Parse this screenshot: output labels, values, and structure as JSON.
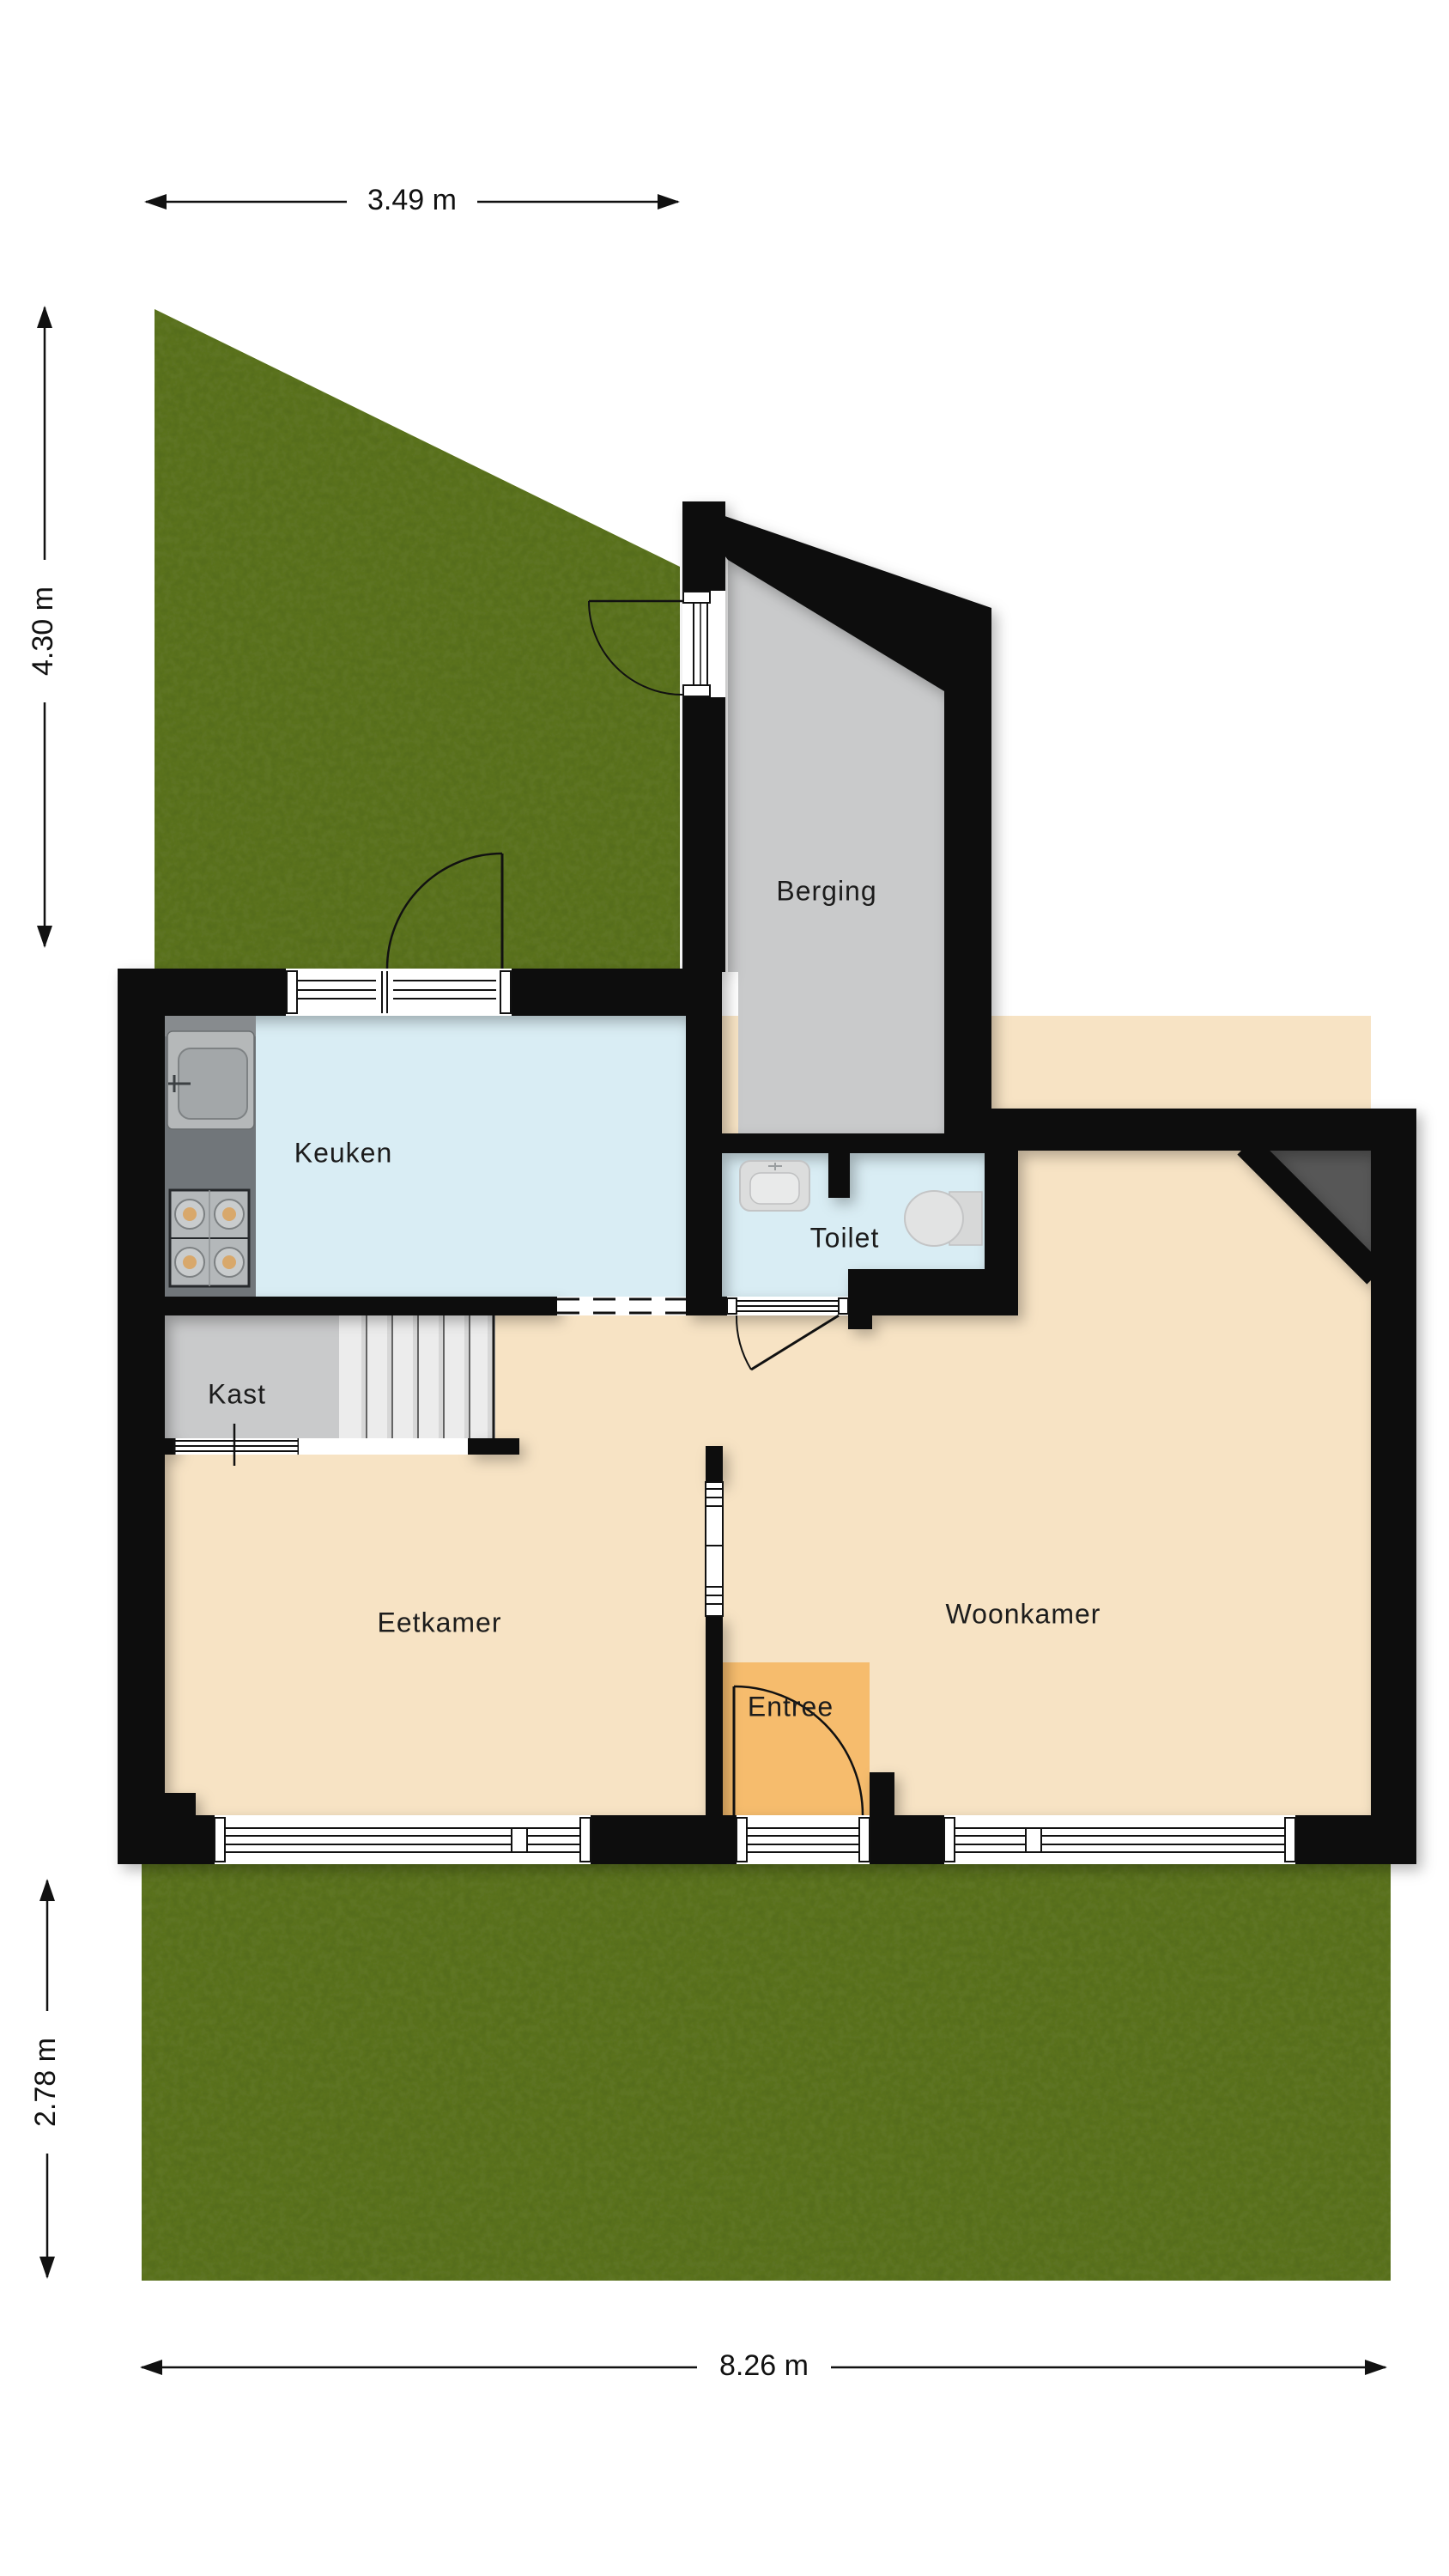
{
  "plan": {
    "type": "residential-floorplan-ground-floor",
    "units": "m"
  },
  "rooms": [
    {
      "id": "berging",
      "label": "Berging"
    },
    {
      "id": "keuken",
      "label": "Keuken"
    },
    {
      "id": "toilet",
      "label": "Toilet"
    },
    {
      "id": "kast",
      "label": "Kast"
    },
    {
      "id": "eetkamer",
      "label": "Eetkamer"
    },
    {
      "id": "woonkamer",
      "label": "Woonkamer"
    },
    {
      "id": "entree",
      "label": "Entree"
    }
  ],
  "dimensions": {
    "top": {
      "label": "3.49 m",
      "orientation": "horizontal"
    },
    "left_upper": {
      "label": "4.30 m",
      "orientation": "vertical"
    },
    "left_lower": {
      "label": "2.78 m",
      "orientation": "vertical"
    },
    "bottom": {
      "label": "8.26 m",
      "orientation": "horizontal"
    }
  },
  "colors": {
    "wall": "#0d0d0d",
    "floor": "#f7e3c4",
    "wet_room": "#d9edf4",
    "storage": "#c9cacb",
    "stairs": "#ededed",
    "entree": "#f6bc6d",
    "grass": "#8ca04f",
    "counter": "#71767a",
    "corner_shadow": "#575757",
    "fixture": "#d9dadb"
  }
}
